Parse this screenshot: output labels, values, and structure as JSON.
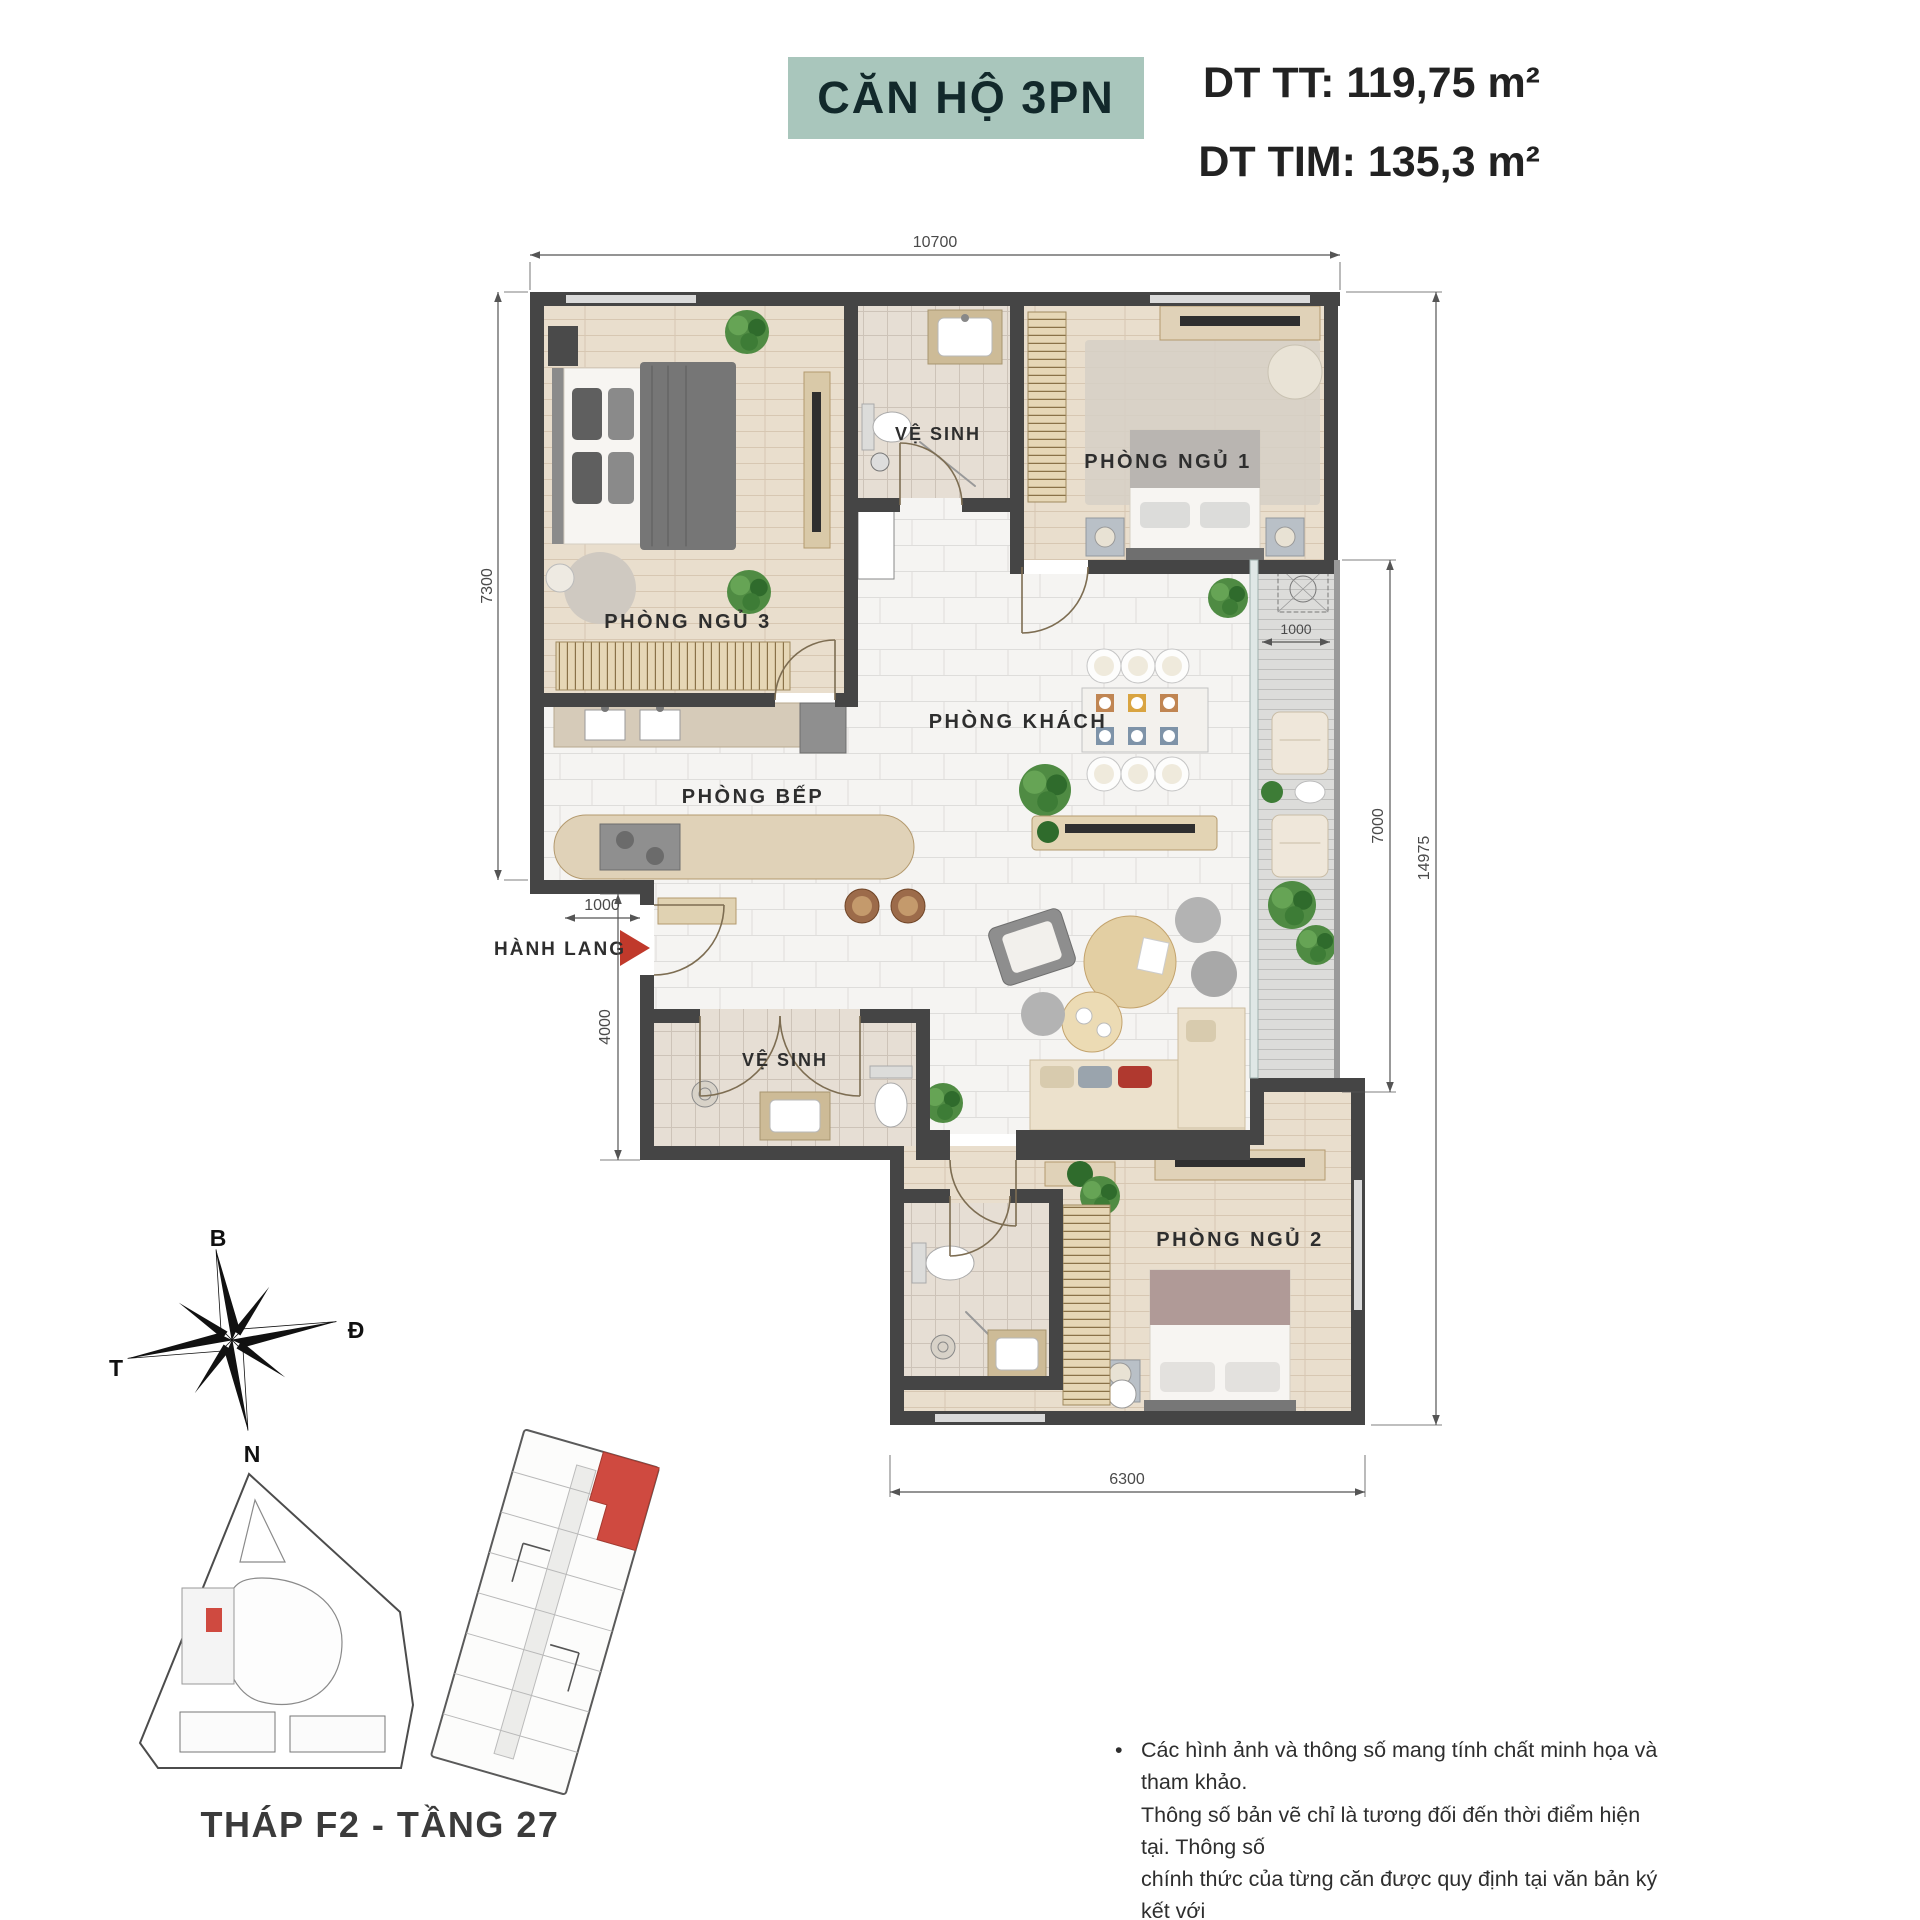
{
  "header": {
    "badge": "CĂN HỘ 3PN",
    "area_net": "DT TT: 119,75 m²",
    "area_gross": "DT TIM: 135,3 m²"
  },
  "rooms": {
    "bedroom3": "PHÒNG NGỦ 3",
    "bedroom1": "PHÒNG NGỦ 1",
    "bedroom2": "PHÒNG NGỦ 2",
    "living": "PHÒNG KHÁCH",
    "kitchen": "PHÒNG BẾP",
    "bathroom": "VỆ SINH",
    "hallway": "HÀNH LANG"
  },
  "dimensions": {
    "top": "10700",
    "left_upper": "7300",
    "left_hall": "1000",
    "left_lower": "4000",
    "right_total": "14975",
    "right_living": "7000",
    "balcony_width": "1000",
    "bottom": "6300"
  },
  "compass": {
    "north": "B",
    "east": "Đ",
    "south": "N",
    "west": "T"
  },
  "locator": {
    "caption": "THÁP F2 - TẦNG 27"
  },
  "disclaimer": {
    "bullet": "•",
    "lines": [
      "Các hình ảnh và thông số mang tính chất minh họa và tham khảo.",
      "Thông số bản vẽ chỉ là tương đối đến thời điểm hiện tại. Thông số",
      "chính thức của từng căn được quy định tại văn bản ký kết với",
      "Khách hàng/Theo quy định của CQNN."
    ]
  },
  "colors": {
    "badge_bg": "#a9c6bc",
    "wall": "#454545",
    "accent_red": "#c0392b",
    "wood_floor": "#e9decd",
    "marble_floor": "#f5f4f2",
    "highlight_unit": "#cf4a40"
  }
}
